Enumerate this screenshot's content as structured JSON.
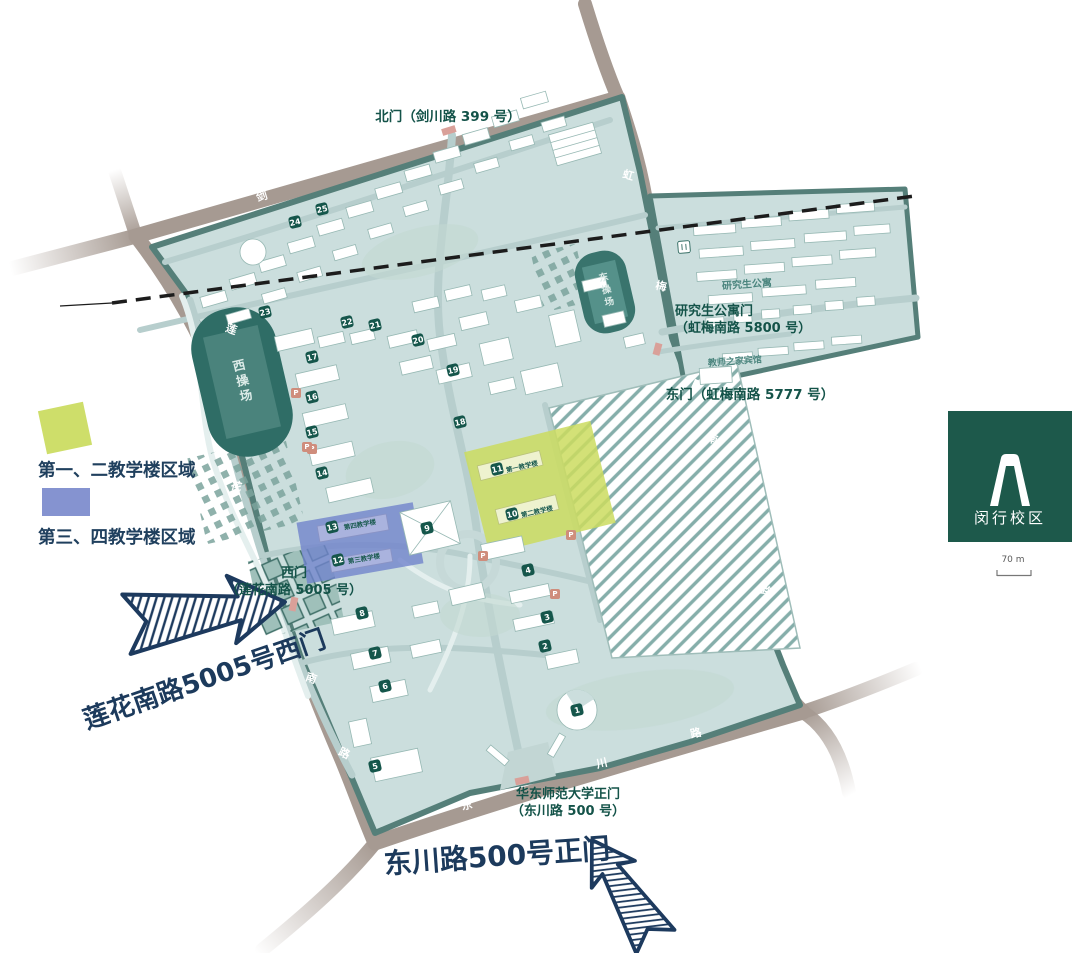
{
  "legend": {
    "items": [
      {
        "label": "第一、二教学楼区域",
        "color": "#cede6a"
      },
      {
        "label": "第三、四教学楼区域",
        "color": "#8593d0"
      }
    ]
  },
  "logo": {
    "campus_name": "闵行校区",
    "icon": "gate-arch-icon",
    "bg_color": "#1d594b"
  },
  "scale_bar": {
    "label": "70 m"
  },
  "map": {
    "labels": [
      {
        "name": "north-gate-label",
        "text": "北门（剑川路 399 号）",
        "x": 448,
        "y": 118,
        "size": 13.5,
        "color": "#145349",
        "weight": 700
      },
      {
        "name": "west-gate-label",
        "text": "西门\n（莲花南路 5005 号）",
        "x": 294,
        "y": 583,
        "size": 13,
        "color": "#145349",
        "weight": 700
      },
      {
        "name": "east-gate-label",
        "text": "东门（虹梅南路 5777 号）",
        "x": 750,
        "y": 396,
        "size": 13.5,
        "color": "#145349",
        "weight": 700
      },
      {
        "name": "grad-gate-label",
        "text": "研究生公寓门\n（虹梅南路 5800 号）",
        "x": 675,
        "y": 321,
        "size": 13,
        "color": "#145349",
        "weight": 700,
        "align": "left"
      },
      {
        "name": "main-gate-label",
        "text": "华东师范大学正门\n（东川路 500 号）",
        "x": 568,
        "y": 804,
        "size": 13,
        "color": "#145349",
        "weight": 700
      },
      {
        "name": "west-arrow-callout",
        "text": "莲花南路5005号西门",
        "x": 205,
        "y": 681,
        "size": 26,
        "color": "#1c3a5c",
        "weight": 800,
        "rotate": -19
      },
      {
        "name": "main-arrow-callout",
        "text": "东川路500号正门",
        "x": 497,
        "y": 857,
        "size": 28,
        "color": "#1c3a5c",
        "weight": 800,
        "rotate": -4
      },
      {
        "name": "west-stadium-label",
        "text": "西操场",
        "x": 241,
        "y": 382,
        "size": 12.5,
        "color": "#dcebe8",
        "weight": 600,
        "rotate": -13,
        "vertical": true
      },
      {
        "name": "east-stadium-label",
        "text": "东操场",
        "x": 605,
        "y": 291,
        "size": 9.5,
        "color": "#dcebe8",
        "weight": 600,
        "rotate": -13,
        "vertical": true
      },
      {
        "name": "grad-apartments-label",
        "text": "研究生公寓",
        "x": 747,
        "y": 285,
        "size": 10,
        "color": "#4b857e",
        "weight": 700,
        "rotate": -4
      },
      {
        "name": "teachers-hotel-label",
        "text": "教师之家宾馆",
        "x": 735,
        "y": 363,
        "size": 9,
        "color": "#4b857e",
        "weight": 600,
        "rotate": -4
      },
      {
        "name": "teach-bldg-1-label",
        "text": "第一教学楼",
        "x": 522,
        "y": 467,
        "size": 6.5,
        "color": "#1b5b50",
        "weight": 600,
        "rotate": -13
      },
      {
        "name": "teach-bldg-2-label",
        "text": "第二教学楼",
        "x": 537,
        "y": 512,
        "size": 6.5,
        "color": "#1b5b50",
        "weight": 600,
        "rotate": -13
      },
      {
        "name": "teach-bldg-4-label",
        "text": "第四教学楼",
        "x": 360,
        "y": 525,
        "size": 6.5,
        "color": "#1b5b50",
        "weight": 600,
        "rotate": -10
      },
      {
        "name": "teach-bldg-3-label",
        "text": "第三教学楼",
        "x": 364,
        "y": 559,
        "size": 6.5,
        "color": "#1b5b50",
        "weight": 600,
        "rotate": -10
      },
      {
        "name": "road-jianchuan-char-1",
        "text": "剑",
        "x": 262,
        "y": 197,
        "size": 11,
        "color": "#ffffff",
        "weight": 700,
        "rotate": -17
      },
      {
        "name": "road-jianchuan-char-2",
        "text": "川",
        "x": 376,
        "y": 154,
        "size": 11,
        "color": "#ffffff",
        "weight": 700,
        "rotate": -17
      },
      {
        "name": "road-jianchuan-char-3",
        "text": "路",
        "x": 514,
        "y": 103,
        "size": 11,
        "color": "#ffffff",
        "weight": 700,
        "rotate": -17
      },
      {
        "name": "road-lianhua-char-1",
        "text": "莲",
        "x": 231,
        "y": 330,
        "size": 11,
        "color": "#ffffff",
        "weight": 700,
        "rotate": 20
      },
      {
        "name": "road-lianhua-char-2",
        "text": "花",
        "x": 236,
        "y": 487,
        "size": 11,
        "color": "#ffffff",
        "weight": 700,
        "rotate": 15
      },
      {
        "name": "road-lianhua-char-3",
        "text": "南",
        "x": 311,
        "y": 679,
        "size": 11,
        "color": "#ffffff",
        "weight": 700,
        "rotate": 20
      },
      {
        "name": "road-lianhua-char-4",
        "text": "路",
        "x": 344,
        "y": 754,
        "size": 11,
        "color": "#ffffff",
        "weight": 700,
        "rotate": 25
      },
      {
        "name": "road-hongmei-char-1",
        "text": "虹",
        "x": 628,
        "y": 176,
        "size": 11,
        "color": "#ffffff",
        "weight": 700,
        "rotate": 15
      },
      {
        "name": "road-hongmei-char-2",
        "text": "梅",
        "x": 661,
        "y": 287,
        "size": 11,
        "color": "#ffffff",
        "weight": 700,
        "rotate": 12
      },
      {
        "name": "road-hongmei-char-3",
        "text": "南",
        "x": 712,
        "y": 440,
        "size": 11,
        "color": "#ffffff",
        "weight": 700,
        "rotate": 15
      },
      {
        "name": "road-hongmei-char-4",
        "text": "路",
        "x": 766,
        "y": 592,
        "size": 11,
        "color": "#ffffff",
        "weight": 700,
        "rotate": 20
      },
      {
        "name": "road-dongchuan-char-1",
        "text": "东",
        "x": 467,
        "y": 806,
        "size": 11,
        "color": "#ffffff",
        "weight": 700,
        "rotate": -13
      },
      {
        "name": "road-dongchuan-char-2",
        "text": "川",
        "x": 602,
        "y": 764,
        "size": 11,
        "color": "#ffffff",
        "weight": 700,
        "rotate": -13
      },
      {
        "name": "road-dongchuan-char-3",
        "text": "路",
        "x": 696,
        "y": 734,
        "size": 11,
        "color": "#ffffff",
        "weight": 700,
        "rotate": -13
      },
      {
        "name": "scale-label",
        "text": "70 m",
        "x": 1013,
        "y": 561,
        "size": 9,
        "color": "#5a5a5a",
        "weight": 400
      }
    ],
    "building_badges": [
      {
        "n": "1",
        "x": 577,
        "y": 710
      },
      {
        "n": "2",
        "x": 545,
        "y": 646
      },
      {
        "n": "3",
        "x": 547,
        "y": 617
      },
      {
        "n": "4",
        "x": 528,
        "y": 570
      },
      {
        "n": "5",
        "x": 375,
        "y": 766
      },
      {
        "n": "6",
        "x": 385,
        "y": 686
      },
      {
        "n": "7",
        "x": 375,
        "y": 653
      },
      {
        "n": "8",
        "x": 362,
        "y": 613
      },
      {
        "n": "9",
        "x": 427,
        "y": 528
      },
      {
        "n": "10",
        "x": 512,
        "y": 514
      },
      {
        "n": "11",
        "x": 497,
        "y": 469
      },
      {
        "n": "12",
        "x": 338,
        "y": 560
      },
      {
        "n": "13",
        "x": 332,
        "y": 527
      },
      {
        "n": "14",
        "x": 322,
        "y": 473
      },
      {
        "n": "15",
        "x": 312,
        "y": 432
      },
      {
        "n": "16",
        "x": 312,
        "y": 397
      },
      {
        "n": "17",
        "x": 312,
        "y": 357
      },
      {
        "n": "18",
        "x": 460,
        "y": 422
      },
      {
        "n": "19",
        "x": 453,
        "y": 370
      },
      {
        "n": "20",
        "x": 418,
        "y": 340
      },
      {
        "n": "21",
        "x": 375,
        "y": 325
      },
      {
        "n": "22",
        "x": 347,
        "y": 322
      },
      {
        "n": "23",
        "x": 265,
        "y": 312
      },
      {
        "n": "24",
        "x": 295,
        "y": 222
      },
      {
        "n": "25",
        "x": 322,
        "y": 209
      }
    ],
    "parking_icons": [
      {
        "x": 312,
        "y": 449
      },
      {
        "x": 483,
        "y": 556
      },
      {
        "x": 571,
        "y": 535
      },
      {
        "x": 555,
        "y": 594
      },
      {
        "x": 296,
        "y": 393
      },
      {
        "x": 307,
        "y": 447
      }
    ],
    "colors": {
      "campus_fill": "#cbdedd",
      "campus_border": "#557f79",
      "road": "#a69a92",
      "stadium": "#2f6d66",
      "highlight_first_second": "#cbdc5f",
      "highlight_third_fourth": "#7083cc",
      "badge": "#15564b",
      "dashed_boundary": "#1c1c1c",
      "callout": "#1c3a5c"
    }
  }
}
